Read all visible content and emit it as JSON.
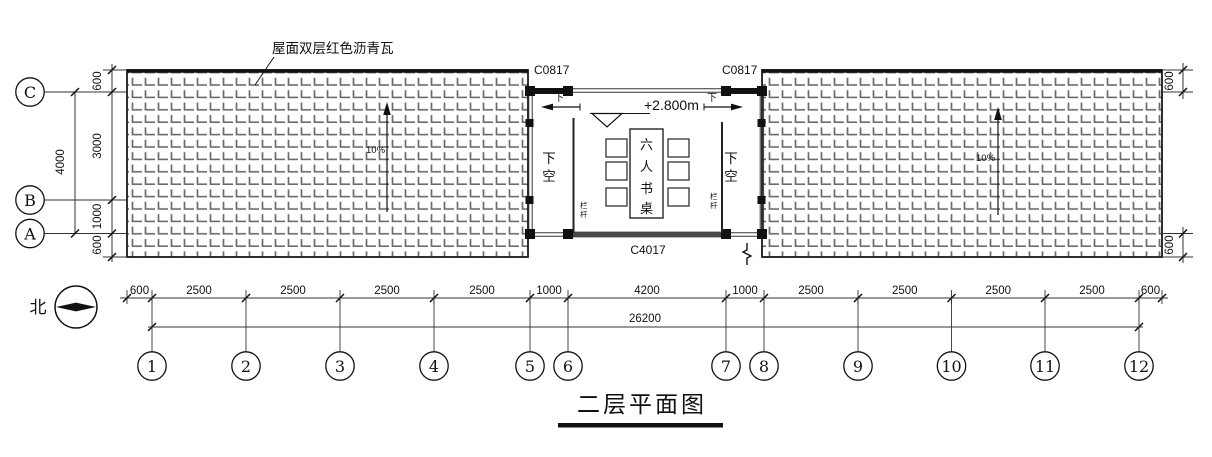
{
  "title": "二层平面图",
  "north_label": "北",
  "roof_note": "屋面双层红色沥青瓦",
  "slope_label": "10%",
  "level_label": "+2.800m",
  "windows": {
    "top_left": "C0817",
    "top_right": "C0817",
    "bottom": "C4017"
  },
  "room": {
    "down": "下",
    "void_chars": [
      "下",
      "空"
    ],
    "desk_chars": [
      "六",
      "人",
      "书",
      "桌"
    ],
    "railing_chars": [
      "栏",
      "杆"
    ]
  },
  "grid": {
    "cols": [
      "1",
      "2",
      "3",
      "4",
      "5",
      "6",
      "7",
      "8",
      "9",
      "10",
      "11",
      "12"
    ],
    "rows": [
      "C",
      "B",
      "A"
    ]
  },
  "dims": {
    "bottom_segments": [
      "600",
      "2500",
      "2500",
      "2500",
      "2500",
      "1000",
      "4200",
      "1000",
      "2500",
      "2500",
      "2500",
      "2500",
      "600"
    ],
    "bottom_total": "26200",
    "left_segments": [
      "600",
      "3000",
      "1000",
      "600"
    ],
    "left_total": "4000",
    "right_segments": [
      "600",
      "600"
    ]
  },
  "colors": {
    "line": "#1a1a1a",
    "hatch": "#6b6b6b",
    "window_band": "#4a4a4a"
  }
}
